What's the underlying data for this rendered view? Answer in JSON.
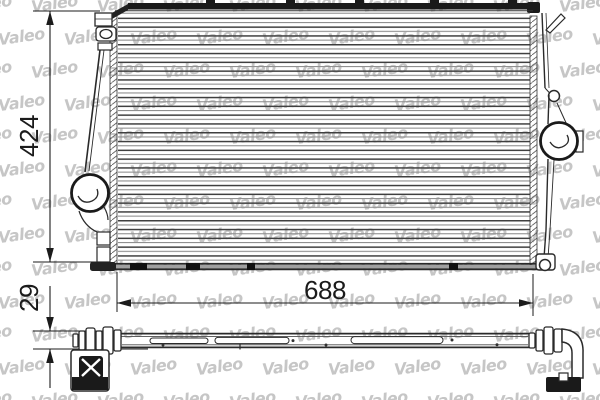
{
  "watermark": {
    "text": "Valeo"
  },
  "dimensions": {
    "height_mm": "424",
    "width_mm": "688",
    "thickness_mm": "29"
  },
  "colors": {
    "background": "#ffffff",
    "line": "#2a2a2a",
    "solid": "#1a1a1a",
    "dim_text": "#1b1b1b",
    "watermark": "#c6c6c6",
    "fin_dark": "#3f3f3f",
    "fin_light": "#8f8f8f"
  }
}
